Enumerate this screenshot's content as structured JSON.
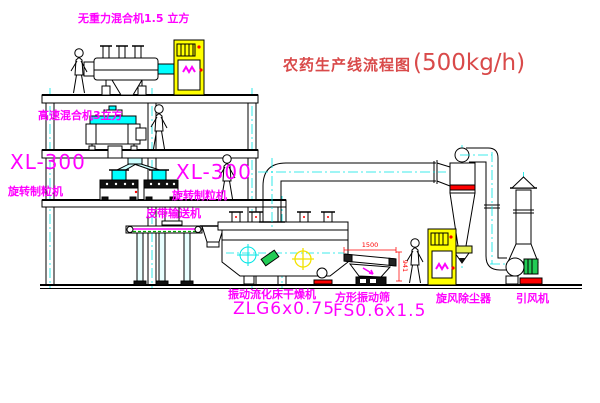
{
  "meta": {
    "width": 600,
    "height": 403,
    "background": "#ffffff"
  },
  "title": {
    "text_cn": "农药生产线流程图",
    "capacity": "(500kg/h)",
    "color": "#d94a4a"
  },
  "labels": {
    "gravity_mixer": "无重力混合机1.5 立方",
    "high_speed_mixer": "高速混合机3立方",
    "granulator_left_model": "XL-300",
    "granulator_left_name": "旋转制粒机",
    "granulator_mid_model": "XL-300",
    "granulator_mid_name": "旋转制粒机",
    "belt_conveyor": "皮带输送机",
    "dryer_name": "振动流化床干燥机",
    "dryer_model": "ZLG6x0.75",
    "sieve_name": "方形振动筛",
    "sieve_model": "FS0.6x1.5",
    "cyclone": "旋风除尘器",
    "fan": "引风机"
  },
  "dimensions": {
    "sieve_length": "1500",
    "sieve_height": "941"
  },
  "colors": {
    "line": "#000000",
    "label_magenta": "#ff00ff",
    "title_red": "#d94a4a",
    "centerline_cyan": "#00e5e5",
    "cabinet_yellow": "#ffff00",
    "alert_red": "#ff0000",
    "motor_green": "#22cc55",
    "belt_green": "#00aa00"
  }
}
